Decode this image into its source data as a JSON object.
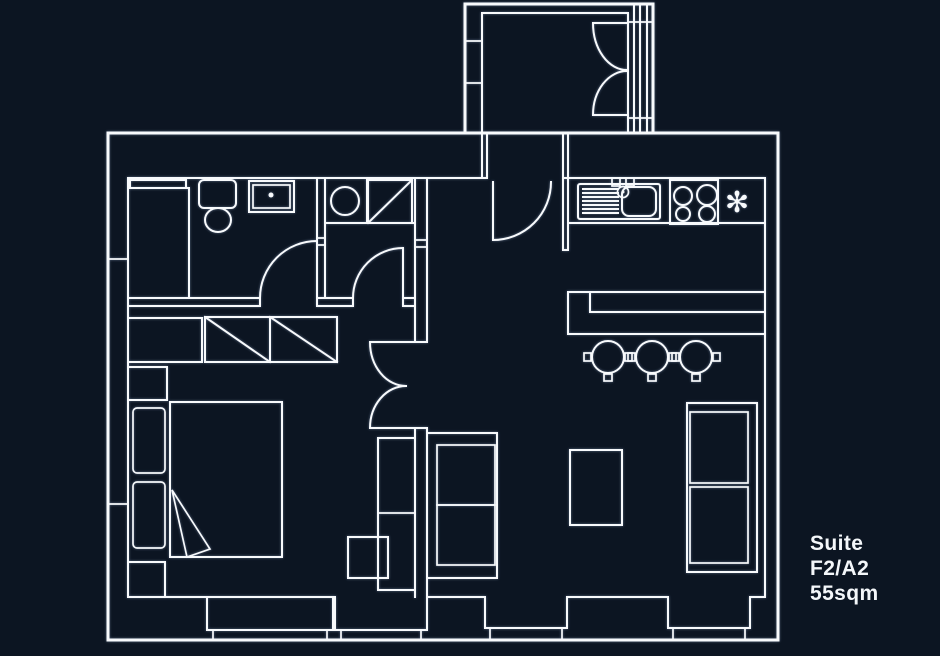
{
  "label": {
    "line1": "Suite",
    "line2": "F2/A2",
    "line3": "55sqm"
  },
  "icons": {
    "extractor_fan": "✻"
  },
  "colors": {
    "background": "#0c1522",
    "line": "#f8fafc",
    "text": "#f4f7fa"
  }
}
